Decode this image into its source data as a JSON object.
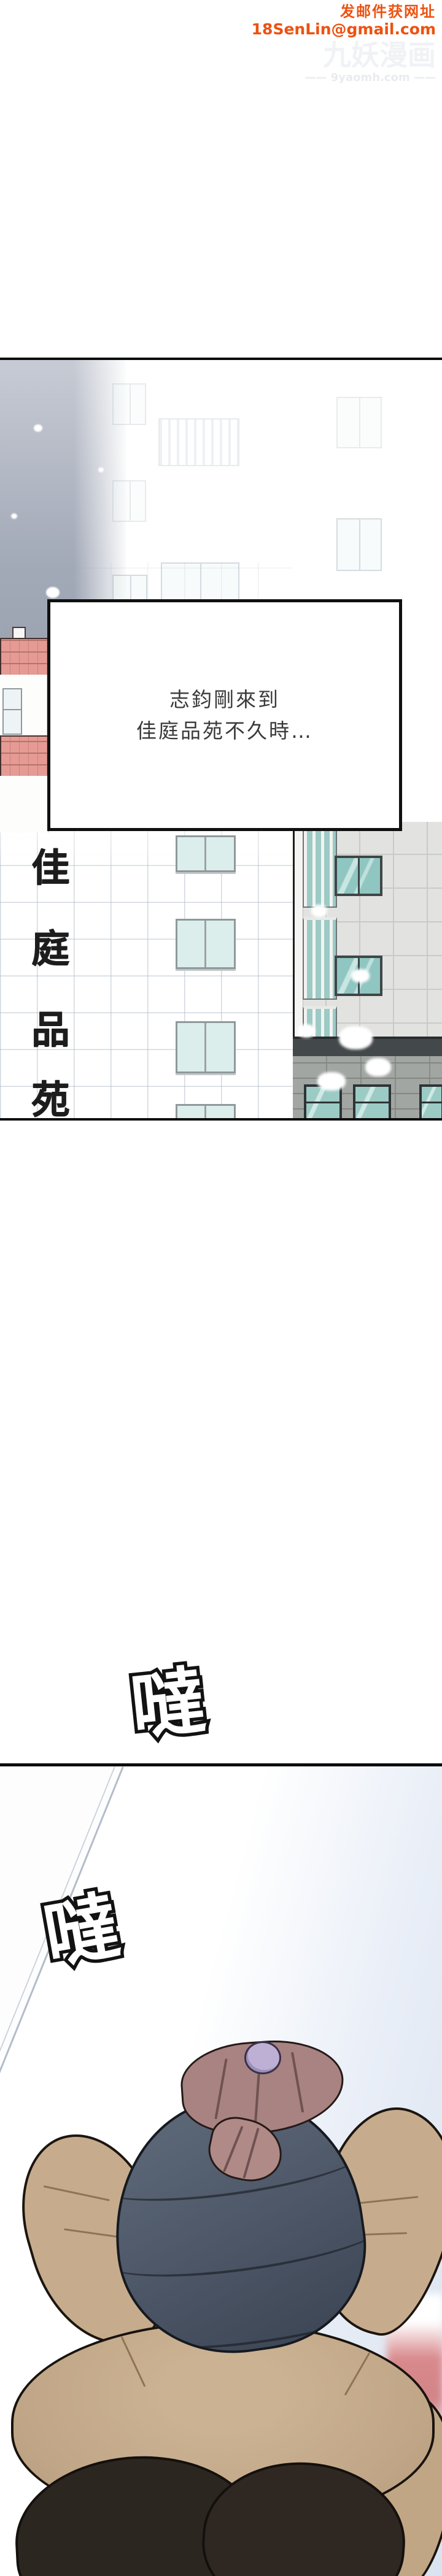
{
  "watermark": {
    "notice": "发邮件获网址",
    "email": "18SenLin@gmail.com",
    "site_name": "九妖漫画",
    "site_url": "—— 9yaomh.com ——"
  },
  "panel1": {
    "narration_line1": "志鈞剛來到",
    "narration_line2": "佳庭品苑不久時…",
    "sign": {
      "name": "佳庭品苑",
      "chars": [
        "佳",
        "庭",
        "品",
        "苑"
      ]
    }
  },
  "sfx": {
    "sfx1": "噠",
    "sfx2": "噠"
  },
  "colors": {
    "watermark_red": "#ee5110",
    "sky_top": "#c7cbd4",
    "sky_bottom": "#8e96a5",
    "roof_pink": "#e59b94",
    "teal_glass": "#9ccac5",
    "vest_blue_grey": "#4e5866",
    "skin_tan": "#c6ac8d",
    "hair_mauve": "#a88381",
    "scrunchie_lavender": "#beb0d4",
    "pants_dark": "#2c2621",
    "pale_blue_bg": "#d9e3f0"
  }
}
